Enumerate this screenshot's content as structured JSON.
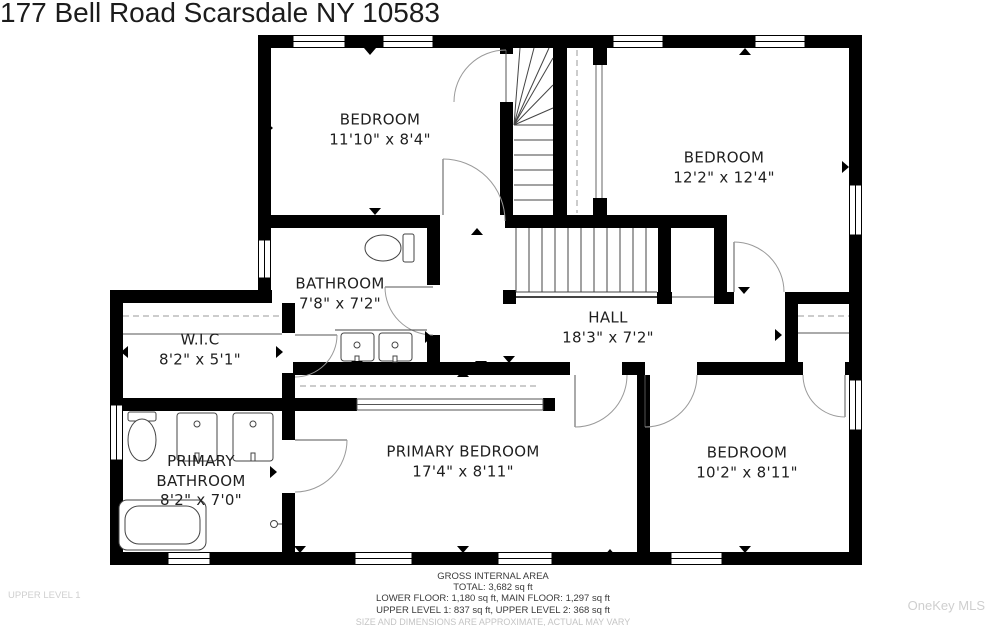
{
  "title": "177 Bell Road Scarsdale NY 10583",
  "rooms": [
    {
      "id": "bedroom-1",
      "name": "BEDROOM",
      "dims": "11'10\" x 8'4\""
    },
    {
      "id": "bedroom-2",
      "name": "BEDROOM",
      "dims": "12'2\" x 12'4\""
    },
    {
      "id": "bathroom",
      "name": "BATHROOM",
      "dims": "7'8\" x 7'2\""
    },
    {
      "id": "hall",
      "name": "HALL",
      "dims": "18'3\" x 7'2\""
    },
    {
      "id": "wic",
      "name": "W.I.C",
      "dims": "8'2\" x 5'1\""
    },
    {
      "id": "primary-bathroom",
      "name": "PRIMARY BATHROOM",
      "dims": "8'2\" x 7'0\""
    },
    {
      "id": "primary-bedroom",
      "name": "PRIMARY BEDROOM",
      "dims": "17'4\" x 8'11\""
    },
    {
      "id": "bedroom-3",
      "name": "BEDROOM",
      "dims": "10'2\" x 8'11\""
    }
  ],
  "footer": {
    "line1": "GROSS INTERNAL AREA",
    "line2": "TOTAL: 3,682 sq ft",
    "line3": "LOWER FLOOR: 1,180 sq ft, MAIN FLOOR: 1,297 sq ft",
    "line4": "UPPER LEVEL 1: 837 sq ft, UPPER LEVEL 2: 368 sq ft",
    "disclaimer": "SIZE AND DIMENSIONS ARE APPROXIMATE, ACTUAL MAY VARY"
  },
  "watermarks": {
    "level_label": "UPPER LEVEL 1",
    "brand_label": "OneKey MLS"
  },
  "colors": {
    "wall": "#000000",
    "label_text": "#1f1f1f",
    "footer_text": "#3a3a3a",
    "watermark_text": "#cfcfcf",
    "fixture_line": "#444444",
    "door_arc": "#9a9a9a"
  }
}
